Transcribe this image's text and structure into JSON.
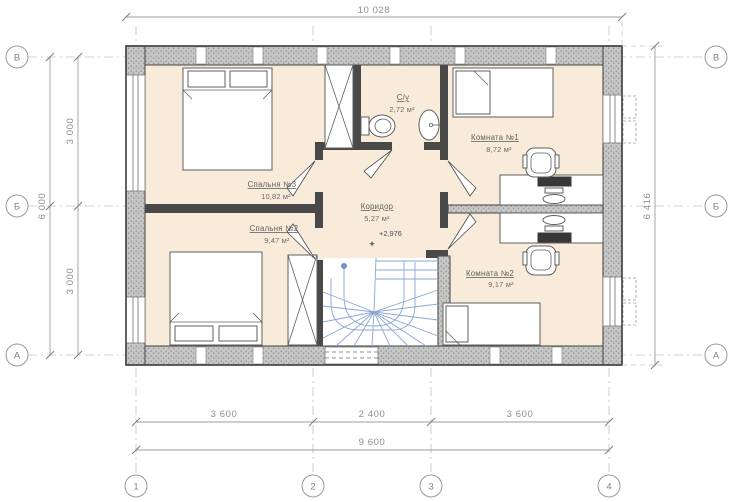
{
  "plan": {
    "rooms": [
      {
        "name": "Спальня №3",
        "area": "10,82 м²"
      },
      {
        "name": "Спальня №2",
        "area": "9,47 м²"
      },
      {
        "name": "С/у",
        "area": "2,72 м²"
      },
      {
        "name": "Коридор",
        "area": "5,27 м²"
      },
      {
        "name": "Комната №1",
        "area": "8,72 м²"
      },
      {
        "name": "Комната №2",
        "area": "9,17 м²"
      }
    ],
    "elevation_mark": "+2,976"
  },
  "dimensions": {
    "top_total": "10 028",
    "right_total": "6 416",
    "left_total": "6 000",
    "left_segments": [
      "3 000",
      "3 000"
    ],
    "bottom_segments": [
      "3 600",
      "2 400",
      "3 600"
    ],
    "bottom_total": "9 600"
  },
  "grid": {
    "row_labels": [
      "В",
      "Б",
      "А"
    ],
    "col_labels": [
      "1",
      "2",
      "3",
      "4"
    ]
  },
  "icons": {
    "elevation_mark": "✦"
  },
  "colors": {
    "room_fill": "#f8ebda",
    "wall_hatch": "#c6c6c6",
    "wall_dark": "#494949",
    "stairs_blue": "#8ca6d5",
    "dim_text": "#8f8f8f"
  }
}
